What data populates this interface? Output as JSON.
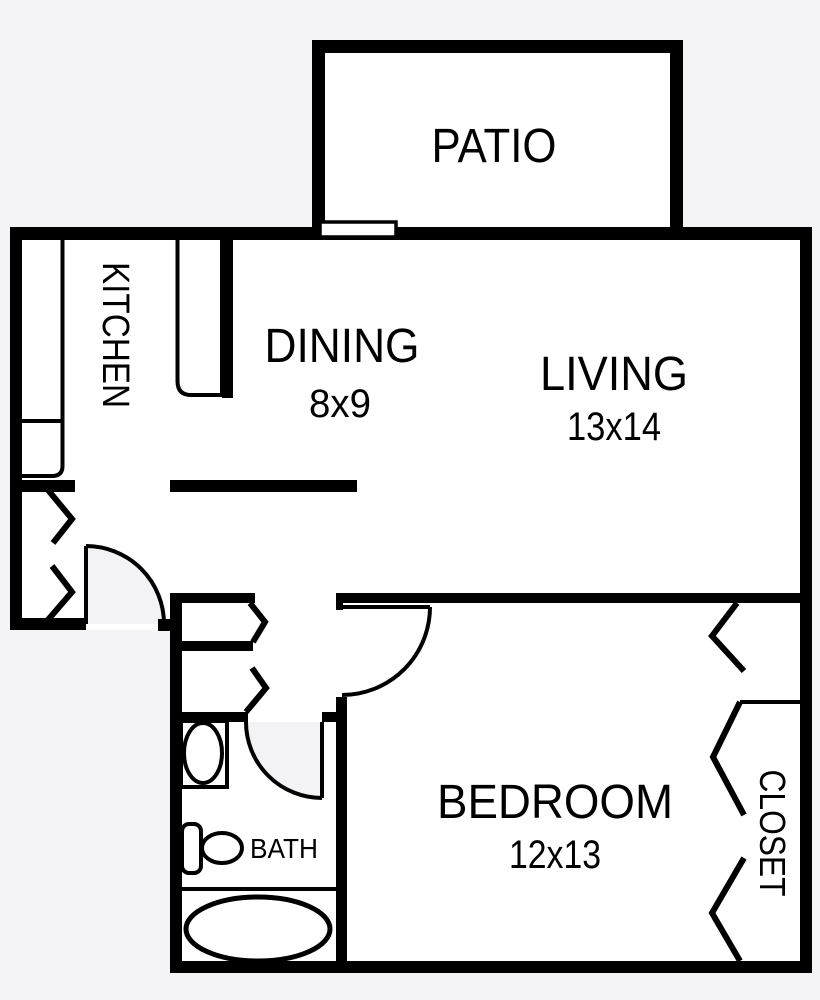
{
  "page": {
    "type": "apartment-floor-plan"
  },
  "rooms": {
    "patio": {
      "label": "PATIO"
    },
    "kitchen": {
      "label": "KITCHEN"
    },
    "dining": {
      "label": "DINING",
      "dims": "8x9"
    },
    "living": {
      "label": "LIVING",
      "dims": "13x14"
    },
    "bedroom": {
      "label": "BEDROOM",
      "dims": "12x13"
    },
    "bath": {
      "label": "BATH"
    },
    "closet": {
      "label": "CLOSET"
    }
  },
  "fixtures": {
    "toilet": "toilet",
    "sink": "sink-with-basin",
    "bathtub": "oval-bathtub",
    "patio_sliding_door": "sliding-glass-door",
    "entry_door": "entry-swing-door",
    "bath_door": "bath-swing-door",
    "bedroom_door": "bedroom-swing-door",
    "bifold_doors": "chevron-bifold-door-marks",
    "kitchen_counters": "kitchen-counters"
  },
  "colors": {
    "background": "#f4f4f6",
    "floor": "#ffffff",
    "walls": "#000000",
    "door_swing_fill": "#f3f3f5",
    "text": "#000000"
  }
}
